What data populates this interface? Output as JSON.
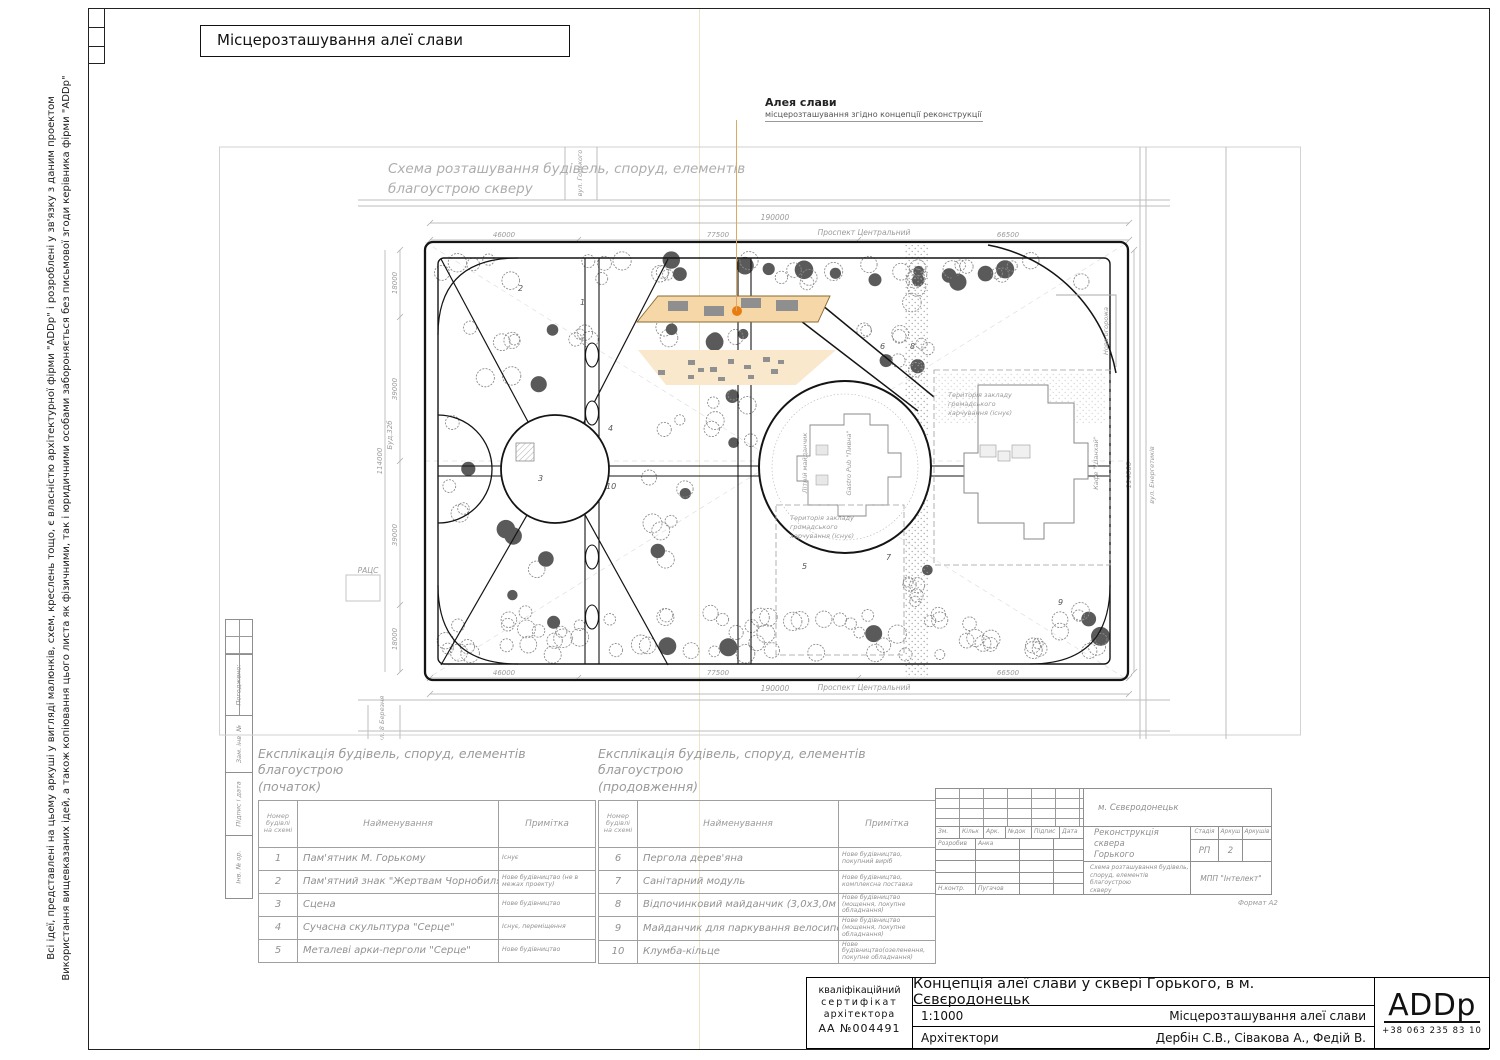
{
  "sheet": {
    "top_title": "Місцерозташування алеї слави",
    "copyright_line1": "Всі ідеї, представлені на цьому аркуші у вигляді малюнків, схем, креслень тощо, є власністю архітектурної фірми \"ADDp\" і розроблені у зв'язку з даним проектом",
    "copyright_line2": "Використання вищевказаних ідей, а також копіювання цього листа як фізичними, так і юридичними особами забороняється без письмової згоди керівника фірми \"ADDp\"",
    "format_label": "Формат А2"
  },
  "annotation": {
    "title": "Алея слави",
    "subtitle": "місцерозташування згідно концепції реконструкції"
  },
  "plan": {
    "title_line1": "Схема розташування будівель, споруд, елементів",
    "title_line2": "благоустрою скверу",
    "street_top": "Проспект Центральний",
    "street_bottom": "Проспект Центральний",
    "street_top_left": "вул. Горького",
    "street_bottom_left": "вул. 8 Березня",
    "street_right": "вул. Енергетиків",
    "dim_total_h": "190000",
    "dim_seg1": "46000",
    "dim_seg2": "77500",
    "dim_seg3": "66500",
    "dim_total_v": "114000",
    "dim_v1": "18000",
    "dim_v2": "39000",
    "dim_v3": "39000",
    "dim_v4": "18000",
    "label_racs": "РАЦС",
    "label_bud": "Буд.32б",
    "label_fence": "Нова огорожа",
    "label_summer": "Літній майданчик",
    "label_gastro": "Gastro Pub \"Пивна\"",
    "label_cafe": "Кафе \"Шанхай\"",
    "territory_l1": "Територія закладу",
    "territory_l2": "громадського",
    "territory_l3": "харчування (існує)",
    "markers": [
      {
        "n": "1",
        "x": 362,
        "y": 160
      },
      {
        "n": "2",
        "x": 300,
        "y": 146
      },
      {
        "n": "3",
        "x": 320,
        "y": 336
      },
      {
        "n": "4",
        "x": 390,
        "y": 286
      },
      {
        "n": "5",
        "x": 584,
        "y": 424
      },
      {
        "n": "6",
        "x": 662,
        "y": 204
      },
      {
        "n": "7",
        "x": 668,
        "y": 415
      },
      {
        "n": "8",
        "x": 692,
        "y": 204
      },
      {
        "n": "9",
        "x": 840,
        "y": 460
      },
      {
        "n": "10",
        "x": 388,
        "y": 344
      }
    ]
  },
  "alley": {
    "fill": "#f6d7a8",
    "fill_light": "#fae8cc",
    "dot_color": "#e87d12"
  },
  "tables": {
    "t1": {
      "title1": "Експлікація будівель, споруд, елементів благоустрою",
      "title2": "(початок)",
      "headers": [
        "Номер будівлі на схемі",
        "Найменування",
        "Примітка"
      ],
      "rows": [
        [
          "1",
          "Пам'ятник М. Горькому",
          "Існує"
        ],
        [
          "2",
          "Пам'ятний знак \"Жертвам Чорнобиля\"",
          "Нове будівництво (не в межах проекту)"
        ],
        [
          "3",
          "Сцена",
          "Нове будівництво"
        ],
        [
          "4",
          "Сучасна скульптура \"Серце\"",
          "Існує, переміщення"
        ],
        [
          "5",
          "Металеві арки-перголи \"Серце\"",
          "Нове будівництво"
        ]
      ]
    },
    "t2": {
      "title1": "Експлікація будівель, споруд, елементів благоустрою",
      "title2": "(продовження)",
      "headers": [
        "Номер будівлі на схемі",
        "Найменування",
        "Примітка"
      ],
      "rows": [
        [
          "6",
          "Пергола дерев'яна",
          "Нове будівництво, покупний виріб"
        ],
        [
          "7",
          "Санітарний модуль",
          "Нове будівництво, комплексна поставка"
        ],
        [
          "8",
          "Відпочинковий майданчик (3,0х3,0м мощення)",
          "Нове будівництво (мощення, покупне обладнання)"
        ],
        [
          "9",
          "Майданчик для паркування велосипедів",
          "Нове будівництво (мощення, покупне обладнання)"
        ],
        [
          "10",
          "Клумба-кільце",
          "Нове будівництво(озеленення, покупне обладнання)"
        ]
      ]
    }
  },
  "margin_column": {
    "approved": "Погоджено:",
    "items": [
      "Зам. інв. №",
      "Підпис і дата",
      "Інв. № ор."
    ]
  },
  "stamp": {
    "cols": [
      "Зм.",
      "Кільк",
      "Арк.",
      "№док",
      "Підпис",
      "Дата"
    ],
    "developed_label": "Розробив",
    "developed_value": "Анка",
    "ncontrol_label": "Н.контр.",
    "ncontrol_value": "Пугачов",
    "city": "м. Сєвєродонецьк",
    "project1": "Реконструкція сквера",
    "project2": "Горького",
    "stage_label": "Стадія",
    "sheet_label": "Аркуш",
    "sheets_label": "Аркушів",
    "stage_value": "РП",
    "sheet_value": "2",
    "drawing1": "Схема розташування будівель,",
    "drawing2": "споруд, елементів благоустрою",
    "drawing3": "скверу",
    "firm": "МПП \"Інтелект\""
  },
  "titleblock": {
    "certificate": [
      "кваліфікаційний",
      "сертифікат",
      "архітектора",
      "АА №004491"
    ],
    "project_title": "Концепція алеї слави у сквері Горького, в м. Сєвєродонецьк",
    "scale": "1:1000",
    "sheet_title": "Місцерозташування алеї слави",
    "role": "Архітектори",
    "names": "Дербін С.В., Сівакова А., Федій В.",
    "logo": "ADDp",
    "phone": "+38  063  235  83  10"
  }
}
